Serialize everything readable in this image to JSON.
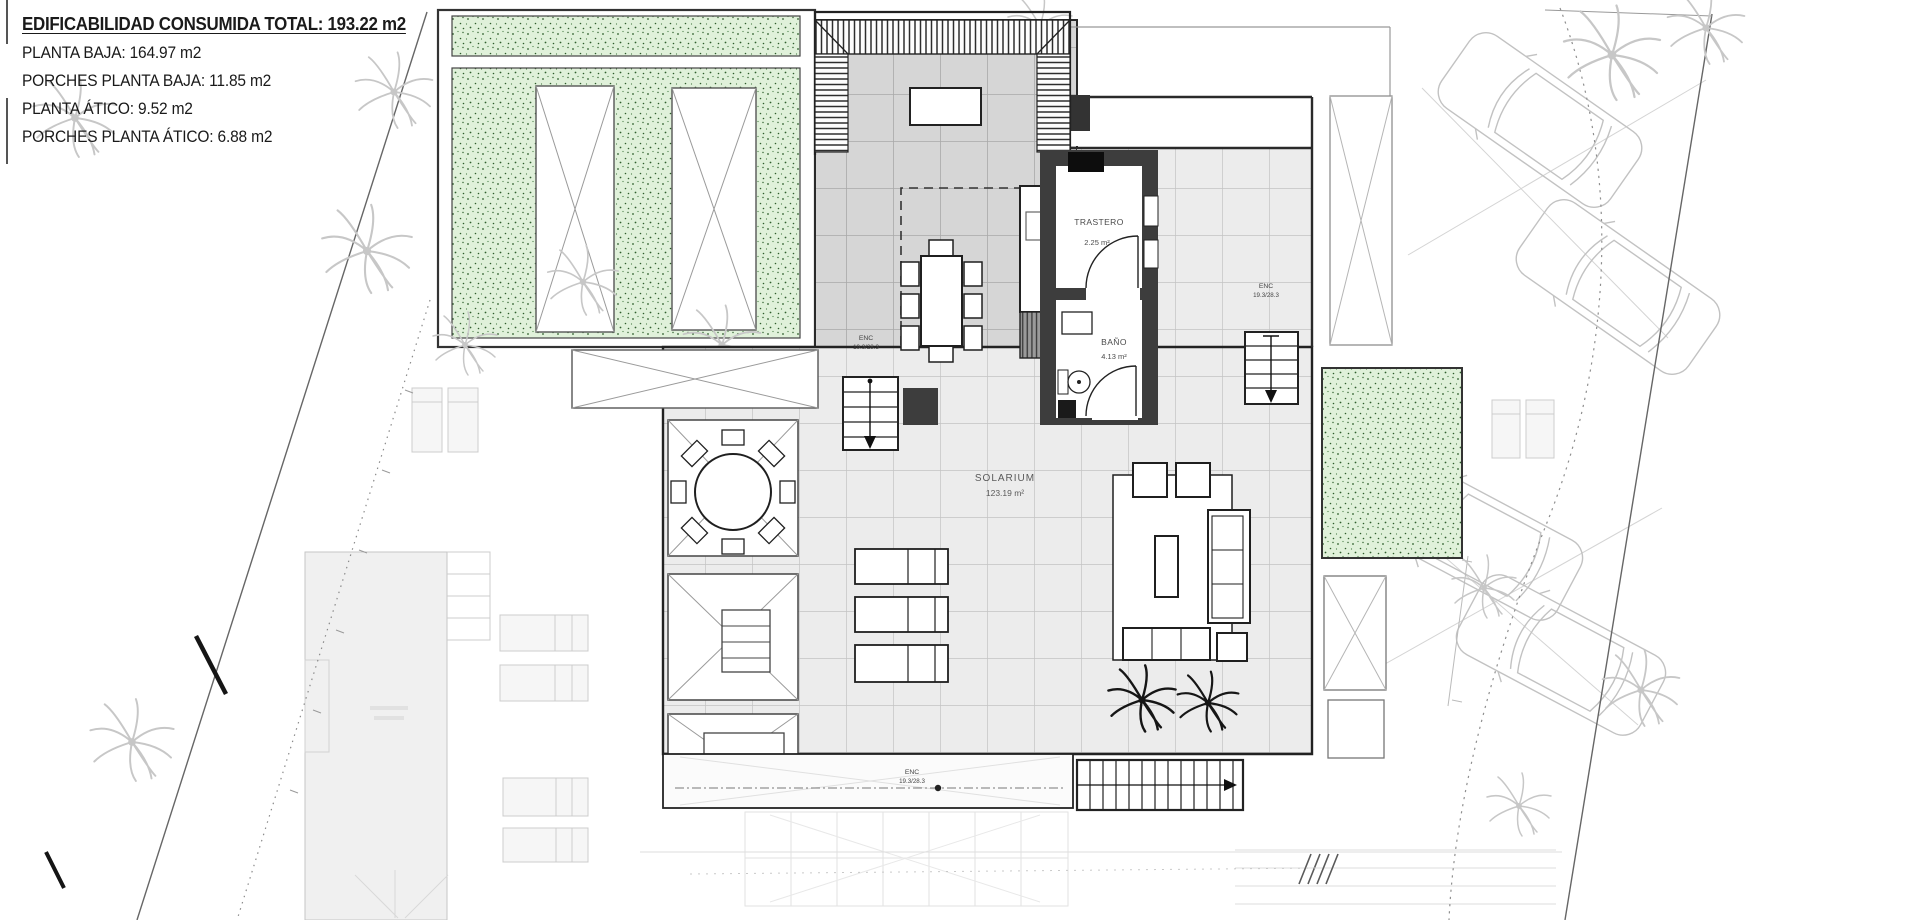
{
  "info_panel": {
    "title": "EDIFICABILIDAD CONSUMIDA TOTAL: 193.22 m2",
    "lines": [
      "PLANTA BAJA: 164.97 m2",
      "PORCHES PLANTA BAJA: 11.85 m2",
      "PLANTA ÁTICO: 9.52 m2",
      "PORCHES PLANTA ÁTICO: 6.88 m2"
    ]
  },
  "rooms": {
    "trastero": {
      "name": "TRASTERO",
      "area": "2.25 m²"
    },
    "bano": {
      "name": "BAÑO",
      "area": "4.13 m²"
    },
    "solarium": {
      "name": "SOLARIUM",
      "area": "123.19 m²"
    }
  },
  "stair_labels": {
    "dining": {
      "line1": "ENC",
      "line2": "19.3/28.3"
    },
    "right": {
      "line1": "ENC",
      "line2": "19.3/28.3"
    },
    "bottom": {
      "line1": "ENC",
      "line2": "19.3/28.3"
    }
  },
  "colors": {
    "planter_green": "#e0f1da",
    "planter_dot": "#2f5e2c",
    "wall_dark": "#3d3d3d",
    "tile_covered": "#d6d6d6",
    "tile_solarium": "#ececec",
    "underlay_gray": "#c9c9c9",
    "line_black": "#222222"
  }
}
